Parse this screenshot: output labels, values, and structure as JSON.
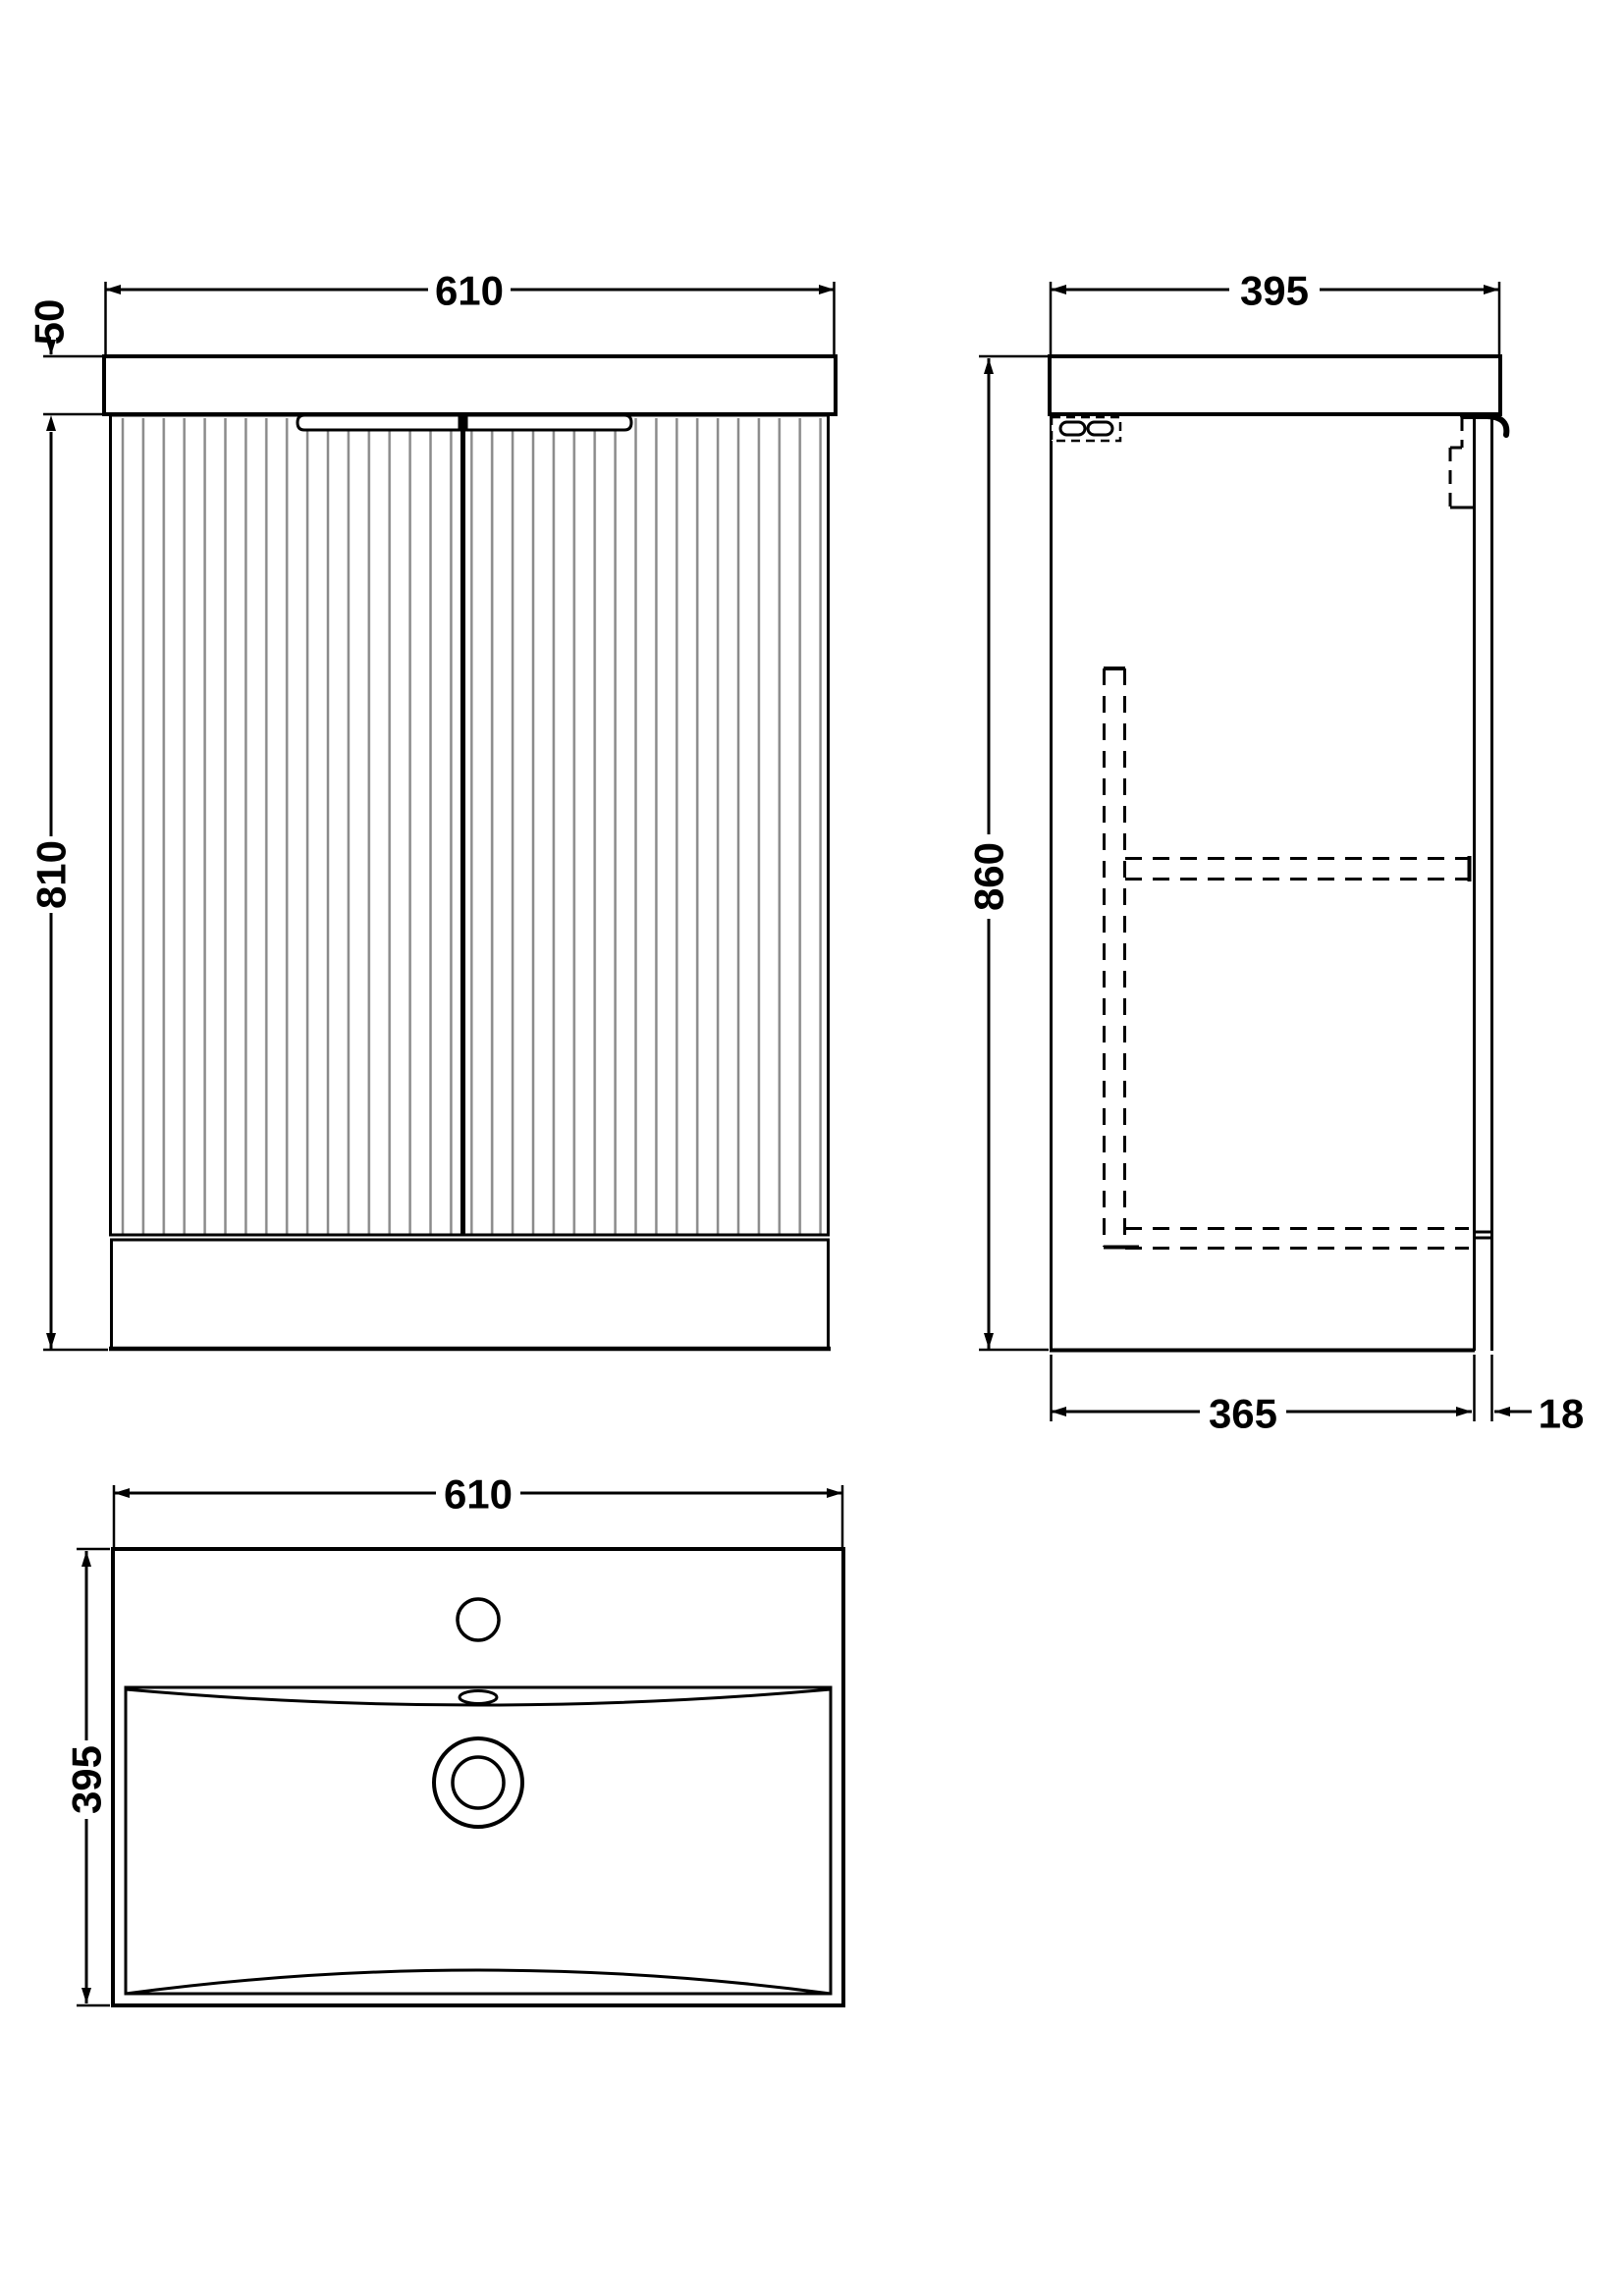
{
  "drawing": {
    "front_view": {
      "width_mm": "610",
      "worktop_height_mm": "50",
      "cabinet_height_mm": "810"
    },
    "side_view": {
      "depth_mm": "395",
      "overall_height_mm": "860",
      "cabinet_depth_mm": "365",
      "door_thickness_mm": "18"
    },
    "basin_plan_view": {
      "width_mm": "610",
      "depth_mm": "395"
    }
  },
  "colors": {
    "line": "#000000",
    "flute": "#8a8a8a",
    "background": "#ffffff"
  }
}
